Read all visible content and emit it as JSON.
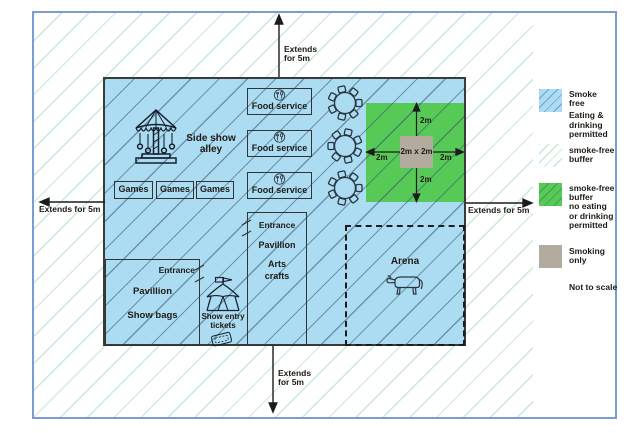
{
  "arrows": {
    "top": [
      "Extends",
      "for 5m"
    ],
    "bottom": [
      "Extends",
      "for 5m"
    ],
    "left": "Extends for 5m",
    "right": "Extends for 5m"
  },
  "map": {
    "side_show": [
      "Side show",
      "alley"
    ],
    "games": [
      "Games",
      "Games",
      "Games"
    ],
    "food": [
      "Food service",
      "Food service",
      "Food service"
    ],
    "smoking_square": "2m x 2m",
    "dims": {
      "top": "2m",
      "bottom": "2m",
      "left": "2m",
      "right": "2m"
    },
    "arena": "Arena",
    "arts_box": [
      "Entrance",
      "Pavillion",
      "Arts",
      "crafts"
    ],
    "showbags_box": {
      "entrance": "Entrance",
      "lines": [
        "Pavillion",
        "Show bags"
      ]
    },
    "tickets": [
      "Show entry",
      "tickets"
    ]
  },
  "legend": {
    "items": [
      {
        "key": "smoke-free",
        "lines": [
          "Smoke",
          "free"
        ],
        "sub": [
          "Eating &",
          "drinking",
          "permitted"
        ]
      },
      {
        "key": "smoke-free-buffer",
        "lines": [
          "smoke-free",
          "buffer"
        ],
        "sub": []
      },
      {
        "key": "green-buffer",
        "lines": [
          "smoke-free",
          "buffer",
          "no eating",
          "or drinking",
          "permitted"
        ],
        "sub": []
      },
      {
        "key": "smoking-only",
        "lines": [
          "Smoking",
          "only"
        ],
        "sub": []
      }
    ],
    "note": "Not to scale"
  },
  "colors": {
    "smoke_free_fill": "#abdcf2",
    "map_hatch_line": "#4e7491",
    "buffer_hatch_line": "#c8e9d5",
    "green_buffer_fill": "#57c957",
    "green_hatch_line": "#3f9e4f",
    "smoking_fill": "#b3ab9e",
    "frame_border": "#7b9cd0",
    "map_border": "#3a3a3a",
    "ink": "#1f1a15"
  }
}
